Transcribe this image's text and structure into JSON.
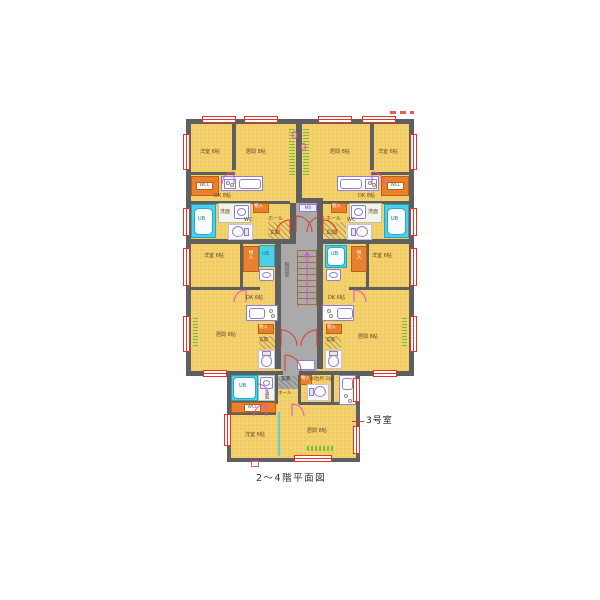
{
  "caption": "2～4階平面図",
  "unit_callout": "3号室",
  "labels": {
    "bedroom6": "洋室 6帖",
    "living8": "居間 8帖",
    "dk8": "DK 8帖",
    "dk6": "DK 6帖",
    "kitchen2": "台所 2帖",
    "ub": "UB",
    "wash": "洗面",
    "wc": "WC",
    "wcl": "WCL",
    "closet": "物入",
    "genkan": "玄関",
    "hall": "ホール",
    "stairwell": "階段室",
    "mb": "MB"
  },
  "colors": {
    "wall": "#5f5f5f",
    "floor": "#f3d26d",
    "floordot": "#e2b34a",
    "wet": "#4ecfe8",
    "storage": "#e8802e",
    "window": "#e03428",
    "fixture": "#8f7fd0",
    "corridor": "#aaaaaa",
    "arc": "#df4fc3",
    "stairs": "#aa6a35",
    "green": "#6abf3a"
  }
}
